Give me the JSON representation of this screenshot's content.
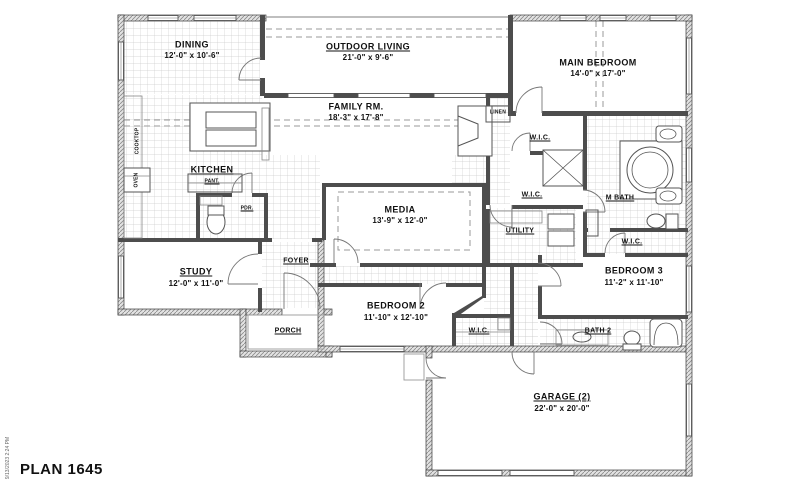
{
  "plan": {
    "title": "PLAN 1645",
    "timestamp": "9/13/2023 2:24 PM"
  },
  "rooms": {
    "dining": {
      "name": "DINING",
      "dims": "12'-0\" x 10'-6\""
    },
    "outdoor": {
      "name": "OUTDOOR LIVING",
      "dims": "21'-0\" x 9'-6\""
    },
    "main_bedroom": {
      "name": "MAIN BEDROOM",
      "dims": "14'-0\" x 17'-0\""
    },
    "family": {
      "name": "FAMILY RM.",
      "dims": "18'-3\" x 17'-8\""
    },
    "kitchen": {
      "name": "KITCHEN"
    },
    "media": {
      "name": "MEDIA",
      "dims": "13'-9\" x 12'-0\""
    },
    "study": {
      "name": "STUDY",
      "dims": "12'-0\" x 11'-0\""
    },
    "bedroom2": {
      "name": "BEDROOM 2",
      "dims": "11'-10\" x 12'-10\""
    },
    "bedroom3": {
      "name": "BEDROOM 3",
      "dims": "11'-2\" x 11'-10\""
    },
    "garage": {
      "name": "GARAGE (2)",
      "dims": "22'-0\" x 20'-0\""
    },
    "mbath": {
      "name": "M BATH"
    },
    "bath2": {
      "name": "BATH 2"
    },
    "utility": {
      "name": "UTILITY"
    },
    "foyer": {
      "name": "FOYER"
    },
    "porch": {
      "name": "PORCH"
    }
  },
  "closets": {
    "wic": "W.I.C.",
    "linen": "LINEN",
    "pantry": "PANT.",
    "powder": "PDR."
  },
  "kitchen_features": {
    "cooktop": "COOKTOP",
    "oven": "OVEN"
  }
}
